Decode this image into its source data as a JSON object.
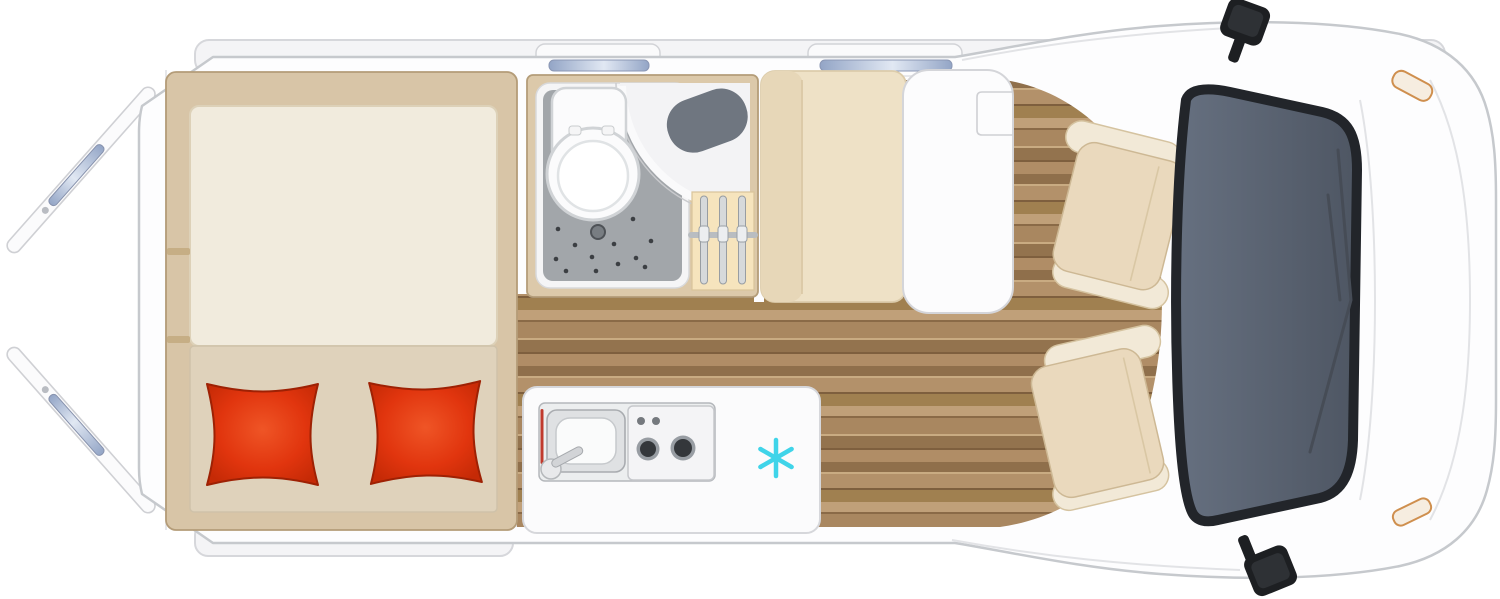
{
  "scene": {
    "title": "Campervan floor plan, top view",
    "fridge_icon_glyph": "✳"
  },
  "colors": {
    "body": "#fdfdfe",
    "outline": "#c6c9cd",
    "inner_line": "#e0e1e5",
    "wood_base": "#a98760",
    "bed_frame": "#d8c5a7",
    "bed_frame_stroke": "#b49c78",
    "mattress": "#f1ebdd",
    "bed_lower": "#dfd2bb",
    "pillow_center": "#ef5526",
    "pillow_mid": "#e1350e",
    "pillow_edge": "#c52a06",
    "pillow_stroke": "#9e2104",
    "bench": "#eee1c6",
    "bench_back": "#e7d7b8",
    "seat": "#ead9bd",
    "armrest": "#f2e9d7",
    "seat_stroke": "#cdb894",
    "table": "#fcfcfd",
    "counter": "#fbfbfc",
    "bathroom_wall": "#dcc9aa",
    "bathroom_wall_stroke": "#b49d79",
    "shower_floor": "#a2a6aa",
    "shower_tray": "#f5f5f6",
    "basin": "#6f7680",
    "hanger_bg": "#f6e4bd",
    "chrome": "#d6d9db",
    "windshield": "#5a6270",
    "windshield_frame": "#22252a",
    "window_glass_dark": "#93a5c6",
    "window_glass_light": "#e1e8f3",
    "snowflake": "#3fd4e9",
    "mirror": "#1d1f22",
    "mirror_face": "#2e3135",
    "headlight": "#cf8f4e",
    "burner_dark": "#34373b",
    "burner_ring": "#989da3"
  }
}
